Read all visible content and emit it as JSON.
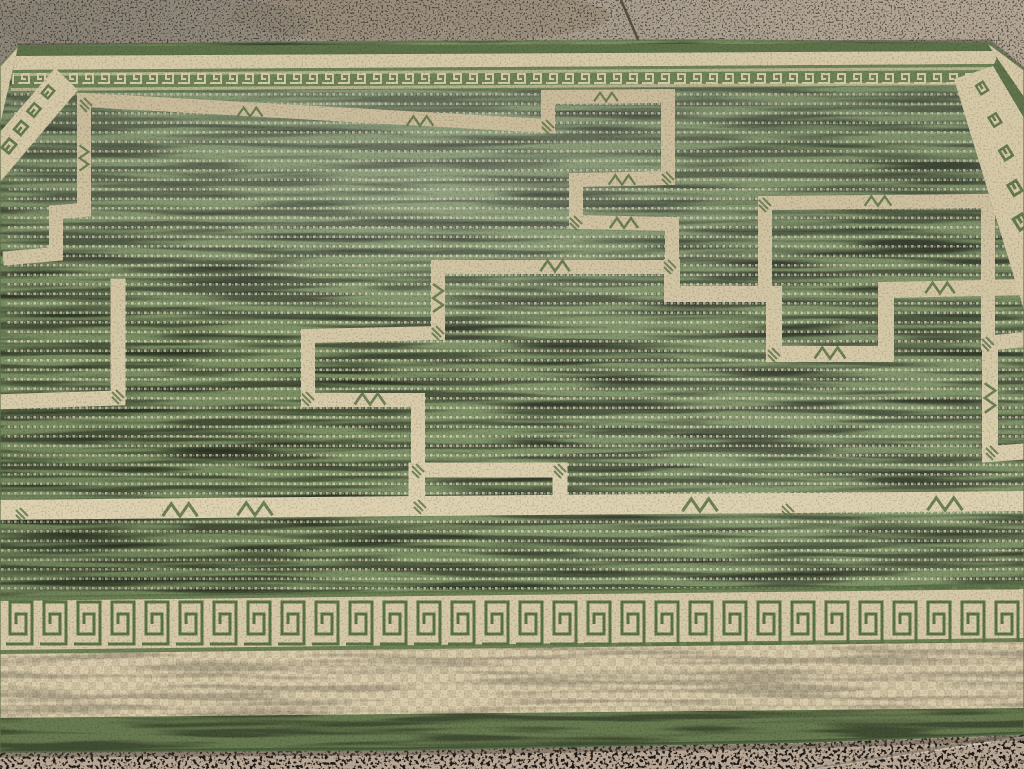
{
  "scene": {
    "title": "Green and cream flat-woven rug photographed on a concrete floor",
    "description": "Photograph of a large hand-woven sage-green rug lying on a speckled concrete floor. The green field is decorated with interlocking stepped cross and fret motifs outlined in cream bands with small green chevron and hatch details. The rug is framed by a Greek-key meander border: a compressed green key band along the top edge, cream key columns running down the left and right edges, and a large green-on-cream key band across the bottom, followed by a wide cream basket-checker band and a plain green outer band. Bare concrete with expansion-joint seams shows along the top and bottom of the frame.",
    "objects": {
      "floor": "speckled concrete with expansion joint seams",
      "rug": "flat-woven carpet with Greek-key borders and stepped cross field"
    }
  },
  "palette": {
    "floorTopA": "#8e8678",
    "floorTopB": "#a79c8c",
    "floorTopC": "#b1a493",
    "floorBottom": "#b9a795",
    "floorSpeckle": "#efe9dc",
    "seamDark": "#453f33",
    "seamLight": "#8a7d6b",
    "rugShadow": "#4a443a",
    "selvageGreen": "#5d7249",
    "cream": "#d6c9a7",
    "creamLight": "#e2d7b6",
    "creamDark": "#c9bb9a",
    "keyGreen": "#5a7247",
    "keyBandGreen": "#6d8256",
    "fieldGreen": "#7b8f63",
    "fieldGreenLight": "#e3e9cd",
    "fieldGreenDark": "#2c3a22",
    "fieldDot": "#e9e1c6",
    "checkerBase": "#d9cdad",
    "checkerDark": "#c0ae8c",
    "bottomGreen": "#66794f",
    "bottomGreenEdge": "#3f5134"
  }
}
